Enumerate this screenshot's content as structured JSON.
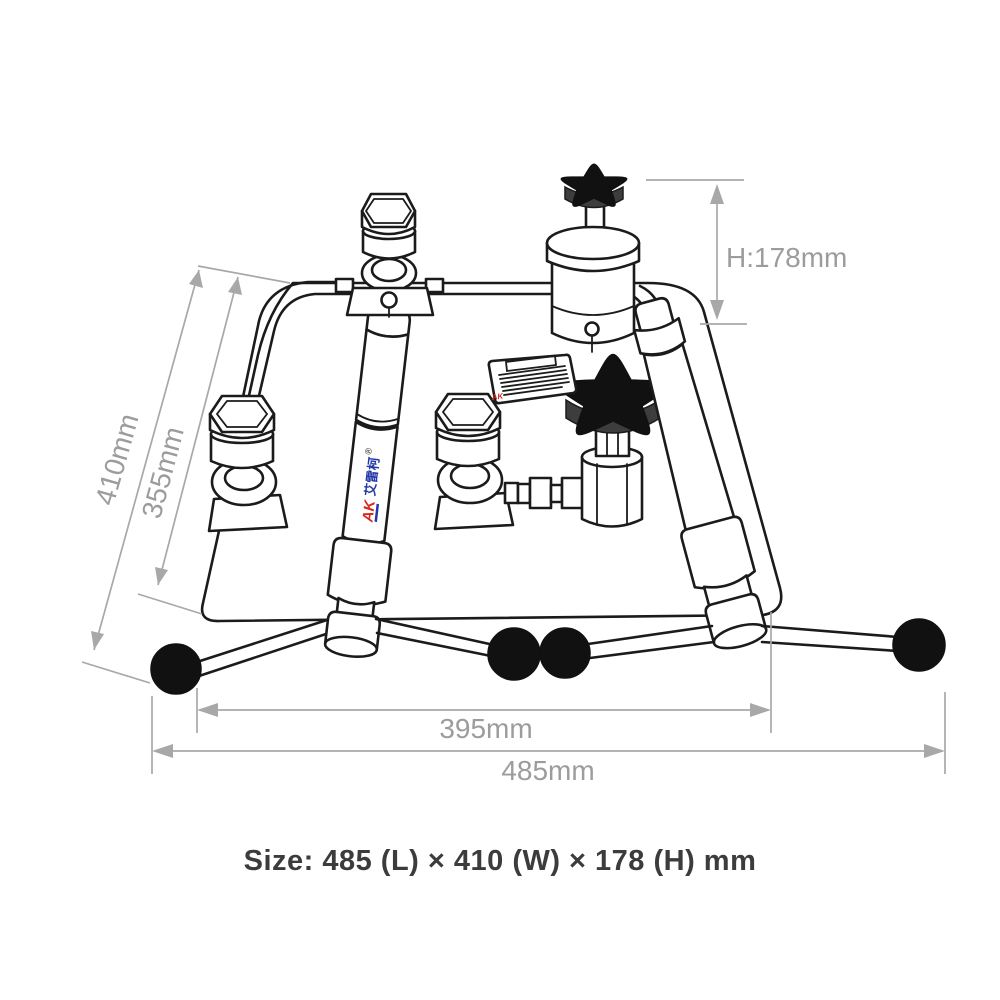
{
  "canvas": {
    "background": "#ffffff",
    "line_color": "#1b1b1b",
    "dim_line_color": "#a8a8a8",
    "dim_text_color": "#9c9c9c"
  },
  "caption": {
    "text": "Size: 485 (L) × 410 (W) × 178 (H) mm",
    "color": "#3c3c3c"
  },
  "dimensions": {
    "height": {
      "label": "H:178mm"
    },
    "outer_width": {
      "label": "410mm"
    },
    "inner_width": {
      "label": "355mm"
    },
    "inner_length": {
      "label": "395mm"
    },
    "outer_length": {
      "label": "485mm"
    }
  },
  "brand": {
    "logo": "AK",
    "name": "艾雷柯",
    "registered": "®",
    "logo_red": "#d6281d",
    "logo_blue": "#2339a8"
  }
}
